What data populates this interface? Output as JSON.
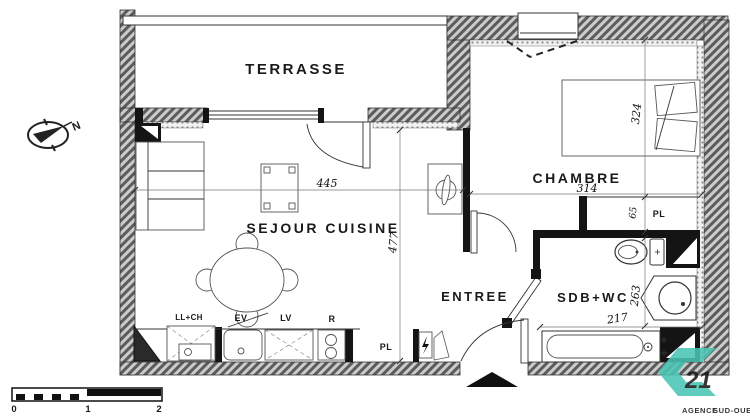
{
  "plan": {
    "rooms": {
      "terrasse": "TERRASSE",
      "sejour": "SEJOUR CUISINE",
      "chambre": "CHAMBRE",
      "entree": "ENTREE",
      "sdb": "SDB+WC"
    },
    "labels": {
      "pl_chambre": "PL",
      "pl_entree": "PL",
      "ll_ch": "LL+CH",
      "ev": "EV",
      "lv": "LV",
      "r": "R",
      "north": "N"
    },
    "dimensions": {
      "sejour_width": "445",
      "sejour_depth": "477",
      "chambre_width": "314",
      "chambre_depth": "324",
      "closet_depth": "65",
      "sdb_depth": "263",
      "sdb_width": "217"
    },
    "scalebar": {
      "t0": "0",
      "t1": "1",
      "t2": "2"
    }
  },
  "logo": {
    "number": "21",
    "agency": "AGENCE",
    "region": "SUD-OUEST",
    "teal": "#49c5b4",
    "gray": "#97a0a7"
  }
}
